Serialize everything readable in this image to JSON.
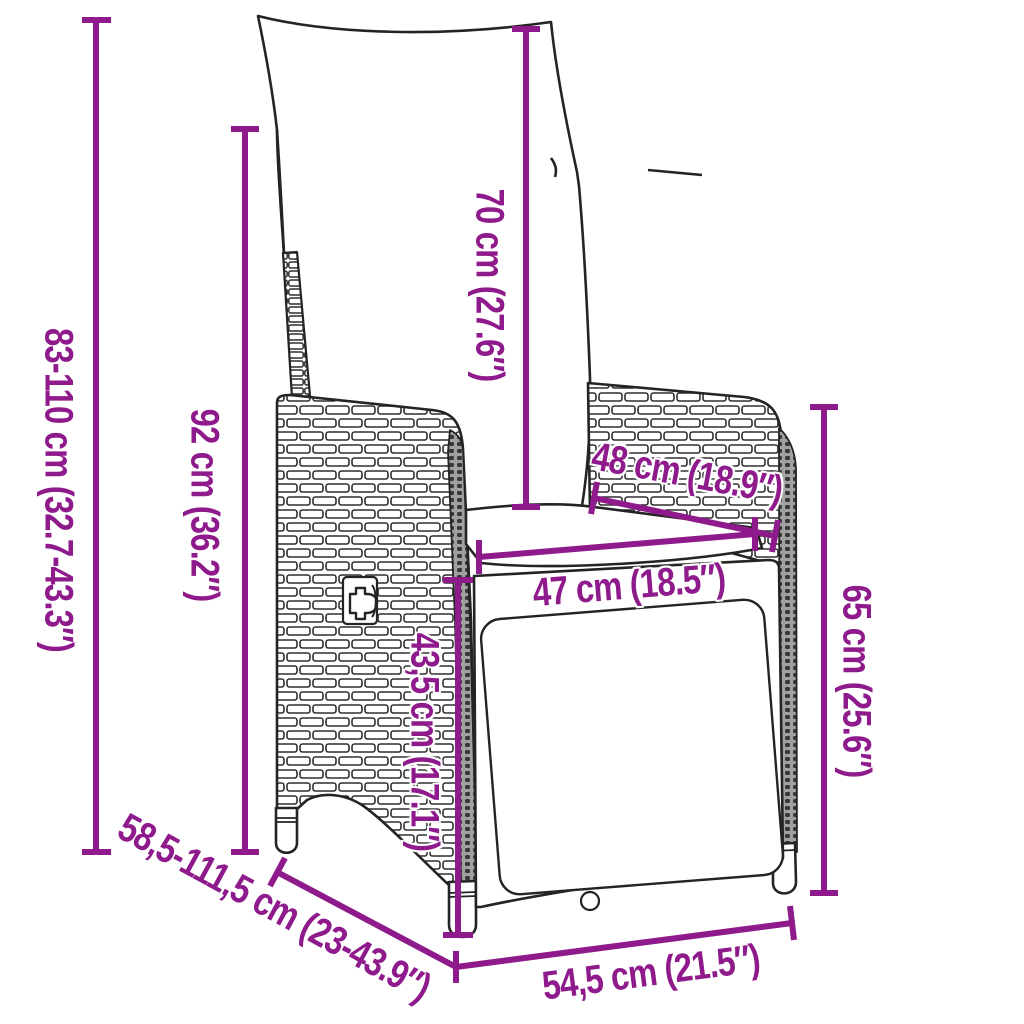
{
  "diagram": {
    "title": "Reclining garden chair dimension diagram",
    "accent_color": "#8e1a8c",
    "line_art_color": "#242424",
    "artwork": "wicker-reclining-garden-chair-line-art",
    "dimensions": [
      {
        "id": "total-height",
        "label": "83-110 cm (32.7-43.3″)",
        "orientation": "vertical"
      },
      {
        "id": "backrest-height",
        "label": "92 cm (36.2″)",
        "orientation": "vertical"
      },
      {
        "id": "cushion-height",
        "label": "70 cm (27.6″)",
        "orientation": "vertical"
      },
      {
        "id": "seat-depth",
        "label": "48 cm (18.9″)",
        "orientation": "diagonal"
      },
      {
        "id": "seat-width",
        "label": "47 cm (18.5″)",
        "orientation": "horizontal"
      },
      {
        "id": "seat-height",
        "label": "43,5 cm (17.1″)",
        "orientation": "vertical"
      },
      {
        "id": "armrest-height",
        "label": "65 cm (25.6″)",
        "orientation": "vertical"
      },
      {
        "id": "total-depth",
        "label": "58,5-111,5 cm (23-43.9″)",
        "orientation": "diagonal"
      },
      {
        "id": "base-width",
        "label": "54,5 cm (21.5″)",
        "orientation": "diagonal"
      }
    ]
  }
}
